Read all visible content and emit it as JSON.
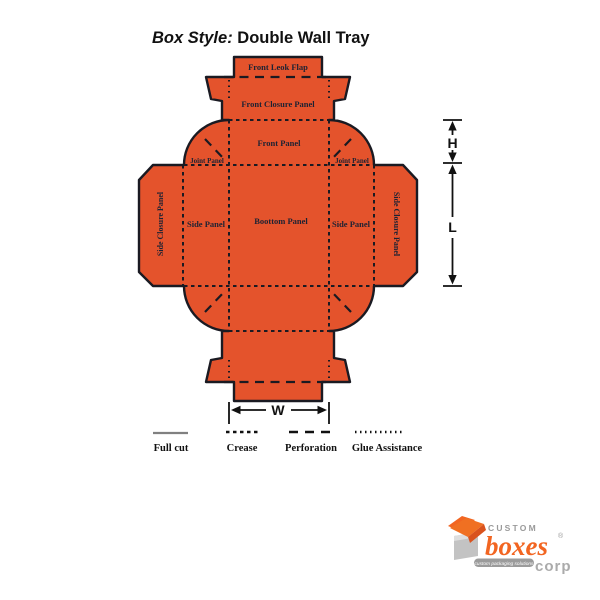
{
  "title": {
    "prefix": "Box Style: ",
    "name": "Double Wall Tray"
  },
  "diagram": {
    "panels": {
      "front_lock_flap": "Front Leok Flap",
      "front_closure": "Front Closure Panel",
      "front_panel": "Front Panel",
      "joint_left": "Joint Panel",
      "joint_right": "Joint Panel",
      "side_left": "Side Panel",
      "side_right": "Side Panel",
      "side_closure_left": "Side Closure Panel",
      "side_closure_right": "Side Closure Panel",
      "bottom": "Boottom Panel"
    },
    "dimensions": {
      "h": "H",
      "l": "L",
      "w": "W"
    },
    "colors": {
      "board": "#E4532C",
      "outline": "#1a1a22",
      "label_text": "#1d2233",
      "logo_orange": "#F26521",
      "logo_gray": "#9a9a9a"
    }
  },
  "legend": {
    "items": [
      {
        "label": "Full cut",
        "style": "solid"
      },
      {
        "label": "Crease",
        "style": "dash-small"
      },
      {
        "label": "Perforation",
        "style": "dash-long"
      },
      {
        "label": "Glue Assistance",
        "style": "dotted"
      }
    ]
  },
  "logo": {
    "brand_top": "CUSTOM",
    "brand_main": "boxes",
    "registered": "®",
    "brand_suffix": "corp",
    "tagline": "custom packaging solutions"
  }
}
